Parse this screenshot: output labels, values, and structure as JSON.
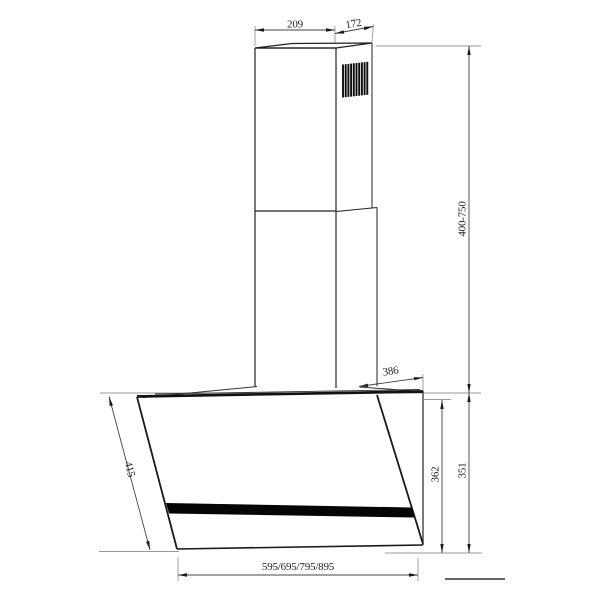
{
  "drawing": {
    "type": "technical-dimension-drawing",
    "subject": "wall-mounted angled cooker hood with telescopic chimney",
    "dimensions": {
      "chimney_width": "209",
      "chimney_depth": "172",
      "chimney_height_range": "400-750",
      "hood_top_depth": "386",
      "hood_back_height": "362",
      "hood_overall_height": "351",
      "glass_panel_length": "415",
      "hood_width_options": "595/695/795/895"
    },
    "colors": {
      "outline": "#222222",
      "dimension_line": "#444444",
      "extension_line": "#999999",
      "glass_strip": "#050505",
      "background": "#ffffff"
    }
  }
}
